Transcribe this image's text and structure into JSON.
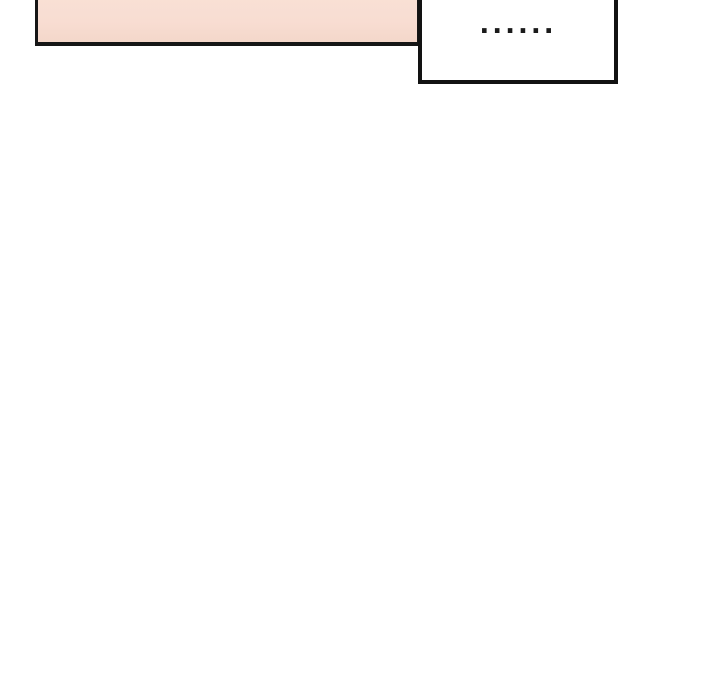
{
  "page": {
    "type": "comic-strip-fragment",
    "background_color": "#ffffff",
    "ink_color": "#161616"
  },
  "panel": {
    "fill_color": "#f8ddd2",
    "border_color": "#161616",
    "note": "pink panel cropped at top edge of image"
  },
  "speech_bubble": {
    "text": "......",
    "fill_color": "#ffffff",
    "border_color": "#121212"
  }
}
